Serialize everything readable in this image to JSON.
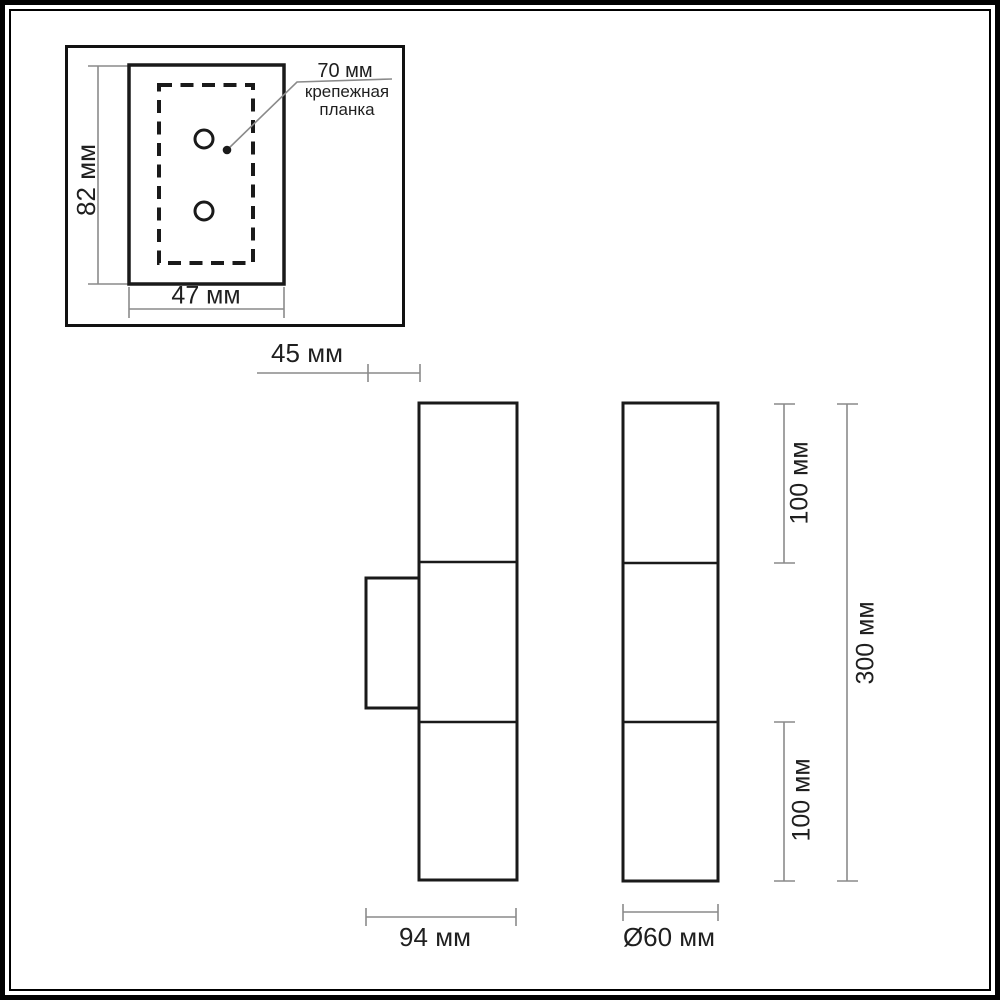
{
  "views": {
    "mounting_plate_detail": {
      "height_label": "82 мм",
      "width_label": "47 мм",
      "hole_spacing_label": "70 мм",
      "caption_line1": "крепежная",
      "caption_line2": "планка"
    },
    "side_view": {
      "wall_offset_label": "45 мм",
      "depth_label": "94 мм"
    },
    "front_view": {
      "top_section_label": "100 мм",
      "bottom_section_label": "100 мм",
      "total_height_label": "300 мм",
      "diameter_label": "Ø60 мм"
    }
  },
  "dimensions_mm": {
    "plate_height": 82,
    "plate_width": 47,
    "hole_spacing": 70,
    "wall_offset": 45,
    "body_depth": 94,
    "shade_diameter": 60,
    "top_section_height": 100,
    "bottom_section_height": 100,
    "total_height": 300
  },
  "colors": {
    "outline": "#1a1a1a",
    "dimension_line": "#8a8a8a",
    "text": "#1f1f1f",
    "frame": "#000000",
    "background": "#ffffff"
  }
}
